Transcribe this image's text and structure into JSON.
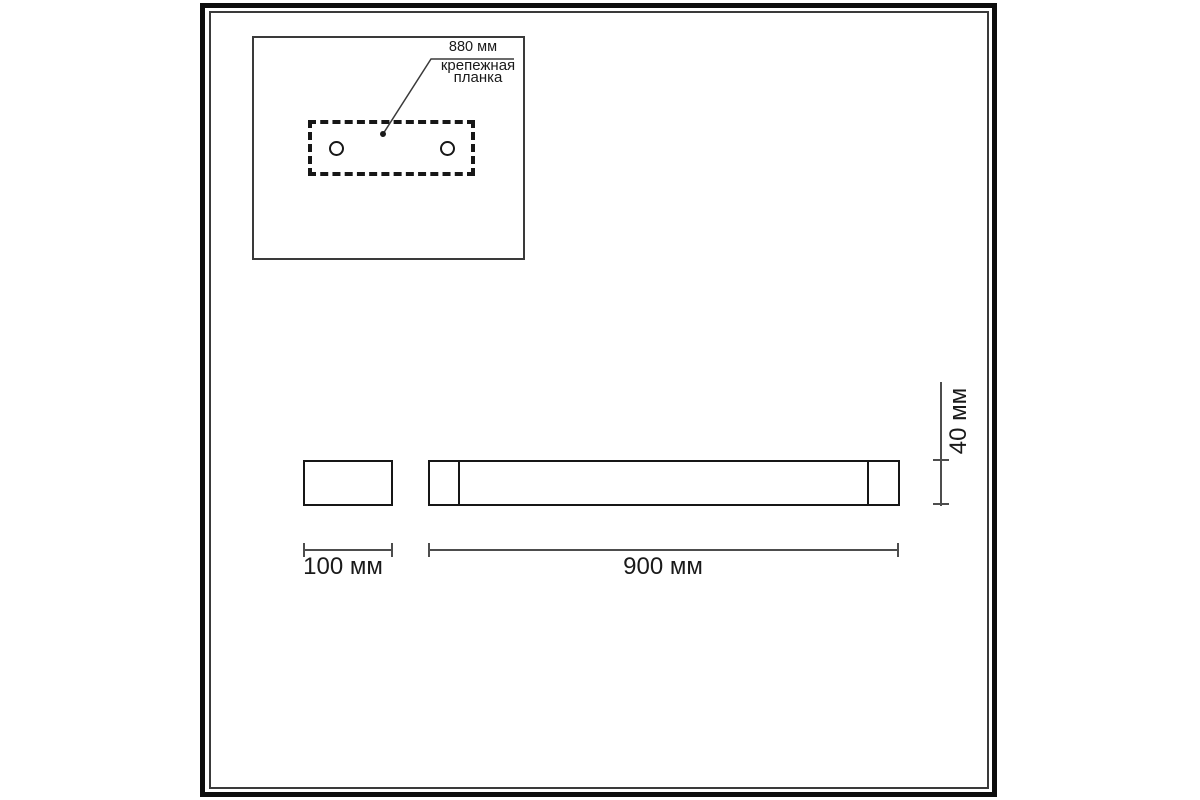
{
  "drawing": {
    "kind": "technical dimension drawing",
    "subject": "linear wall light fixture"
  },
  "inset": {
    "dim_label": "880 мм",
    "part_label": [
      "крепежная",
      "планка"
    ]
  },
  "side_view": {
    "width_label": "100 мм"
  },
  "front_view": {
    "width_label": "900 мм",
    "height_label": "40 мм"
  },
  "colors": {
    "background": "#ffffff",
    "frame": "#0d0d0d",
    "line": "#171717",
    "dim_line": "#4d4d4d",
    "text": "#1a1a1a"
  }
}
